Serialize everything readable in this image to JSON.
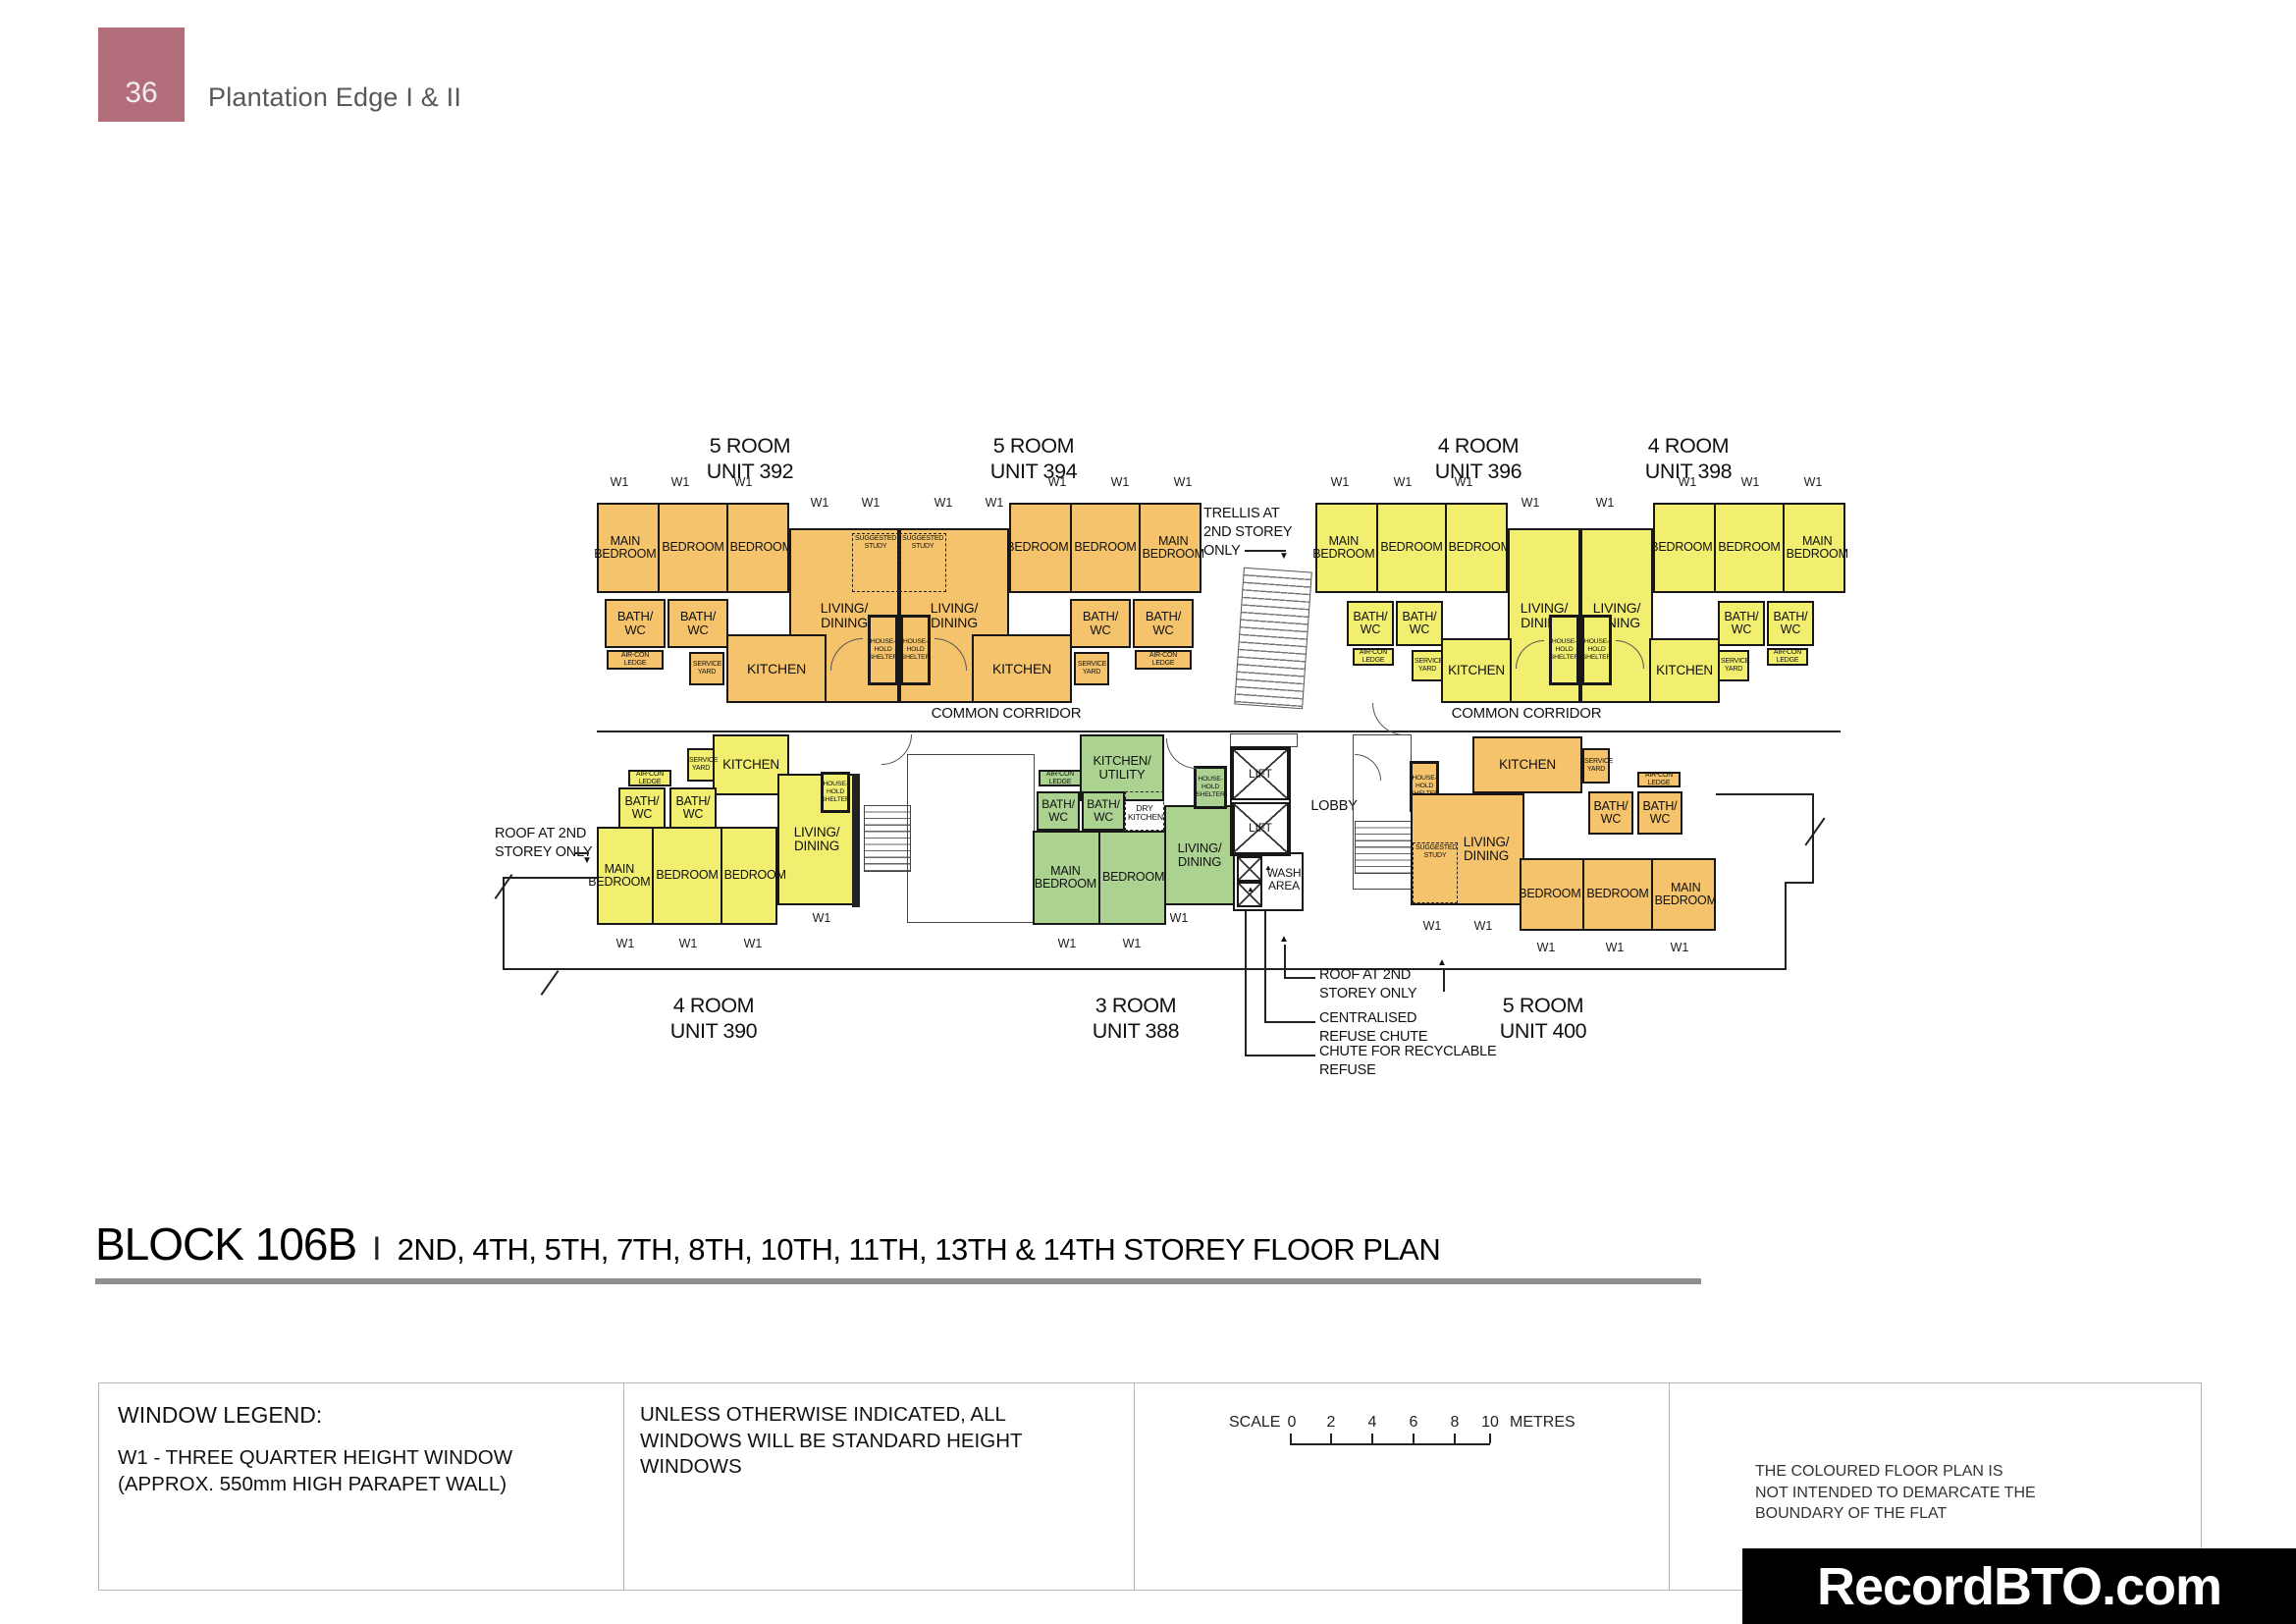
{
  "page": {
    "badge": "36",
    "title": "Plantation Edge I & II"
  },
  "colors": {
    "orange": "#f5c36b",
    "yellow": "#f1ee70",
    "green": "#abd291",
    "badge": "#b26e7b",
    "watermark_bg": "#000000"
  },
  "plan": {
    "room_labels": {
      "main_bedroom": "MAIN BEDROOM",
      "bedroom": "BEDROOM",
      "living_dining": "LIVING/ DINING",
      "bath_wc": "BATH/ WC",
      "kitchen": "KITCHEN",
      "kitchen_utility": "KITCHEN/ UTILITY",
      "dry_kitchen": "DRY KITCHEN",
      "suggested_study": "SUGGESTED STUDY",
      "household_shelter": "HOUSE- HOLD SHELTER",
      "service_yard": "SERVICE YARD",
      "aircon_ledge": "AIR-CON LEDGE",
      "lift": "LIFT",
      "lobby": "LOBBY",
      "wash_area": "WASH AREA",
      "w1": "W1",
      "common_corridor": "COMMON CORRIDOR"
    },
    "units": [
      {
        "id": "392",
        "type": "5 ROOM",
        "unit": "UNIT 392"
      },
      {
        "id": "394",
        "type": "5 ROOM",
        "unit": "UNIT 394"
      },
      {
        "id": "396",
        "type": "4 ROOM",
        "unit": "UNIT 396"
      },
      {
        "id": "398",
        "type": "4 ROOM",
        "unit": "UNIT 398"
      },
      {
        "id": "390",
        "type": "4 ROOM",
        "unit": "UNIT 390"
      },
      {
        "id": "388",
        "type": "3 ROOM",
        "unit": "UNIT 388"
      },
      {
        "id": "400",
        "type": "5 ROOM",
        "unit": "UNIT 400"
      }
    ],
    "annotations": {
      "trellis": "TRELLIS AT 2ND STOREY ONLY",
      "roof": "ROOF AT 2ND STOREY ONLY",
      "centralised_refuse": "CENTRALISED REFUSE CHUTE",
      "recyclable_refuse": "CHUTE FOR RECYCLABLE REFUSE"
    }
  },
  "block_title": {
    "block": "BLOCK 106B",
    "separator": "I",
    "storeys": "2ND, 4TH, 5TH, 7TH, 8TH, 10TH, 11TH, 13TH & 14TH STOREY FLOOR PLAN"
  },
  "legend": {
    "window_legend_title": "WINDOW LEGEND:",
    "w1_description": "W1  -  THREE QUARTER HEIGHT WINDOW (APPROX. 550mm HIGH PARAPET WALL)",
    "windows_note": "UNLESS OTHERWISE INDICATED,  ALL WINDOWS WILL BE STANDARD HEIGHT WINDOWS",
    "scale": {
      "label": "SCALE",
      "ticks": [
        "0",
        "2",
        "4",
        "6",
        "8",
        "10"
      ],
      "unit": "METRES"
    },
    "disclaimer": "THE COLOURED FLOOR PLAN IS NOT INTENDED TO DEMARCATE THE BOUNDARY OF THE FLAT"
  },
  "watermark": "RecordBTO.com"
}
